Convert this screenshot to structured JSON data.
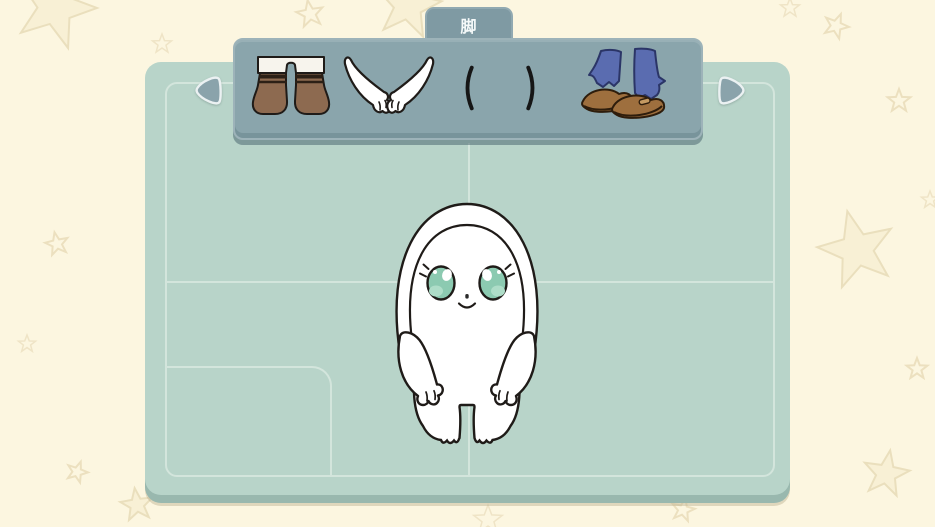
{
  "category_tab": {
    "label": "脚"
  },
  "item_panel": {
    "items": [
      {
        "icon": "brown-boots-icon",
        "description": "brown boots with white cuffs"
      },
      {
        "icon": "white-paws-icon",
        "description": "white animal paws"
      },
      {
        "icon": "thin-legs-icon",
        "description": "thin line legs"
      },
      {
        "icon": "blue-socks-brown-shoes-icon",
        "description": "blue socks with brown shoes"
      }
    ]
  },
  "navigation": {
    "left_icon": "left-arrow-icon",
    "right_icon": "right-arrow-icon"
  },
  "actions": {
    "next_label": "下一步"
  },
  "character_preview": {
    "icon": "white-creature-character",
    "eye_color": "#8ccab1"
  },
  "colors": {
    "background": "#fcf6e0",
    "board": "#b8d4c9",
    "panel": "#8aa5ac",
    "guide_line": "#d3e5dc",
    "button": "#8ba6ad",
    "boot_brown": "#8d6a50",
    "sock_blue": "#5a6cb0",
    "shoe_brown": "#9e6f3e"
  }
}
